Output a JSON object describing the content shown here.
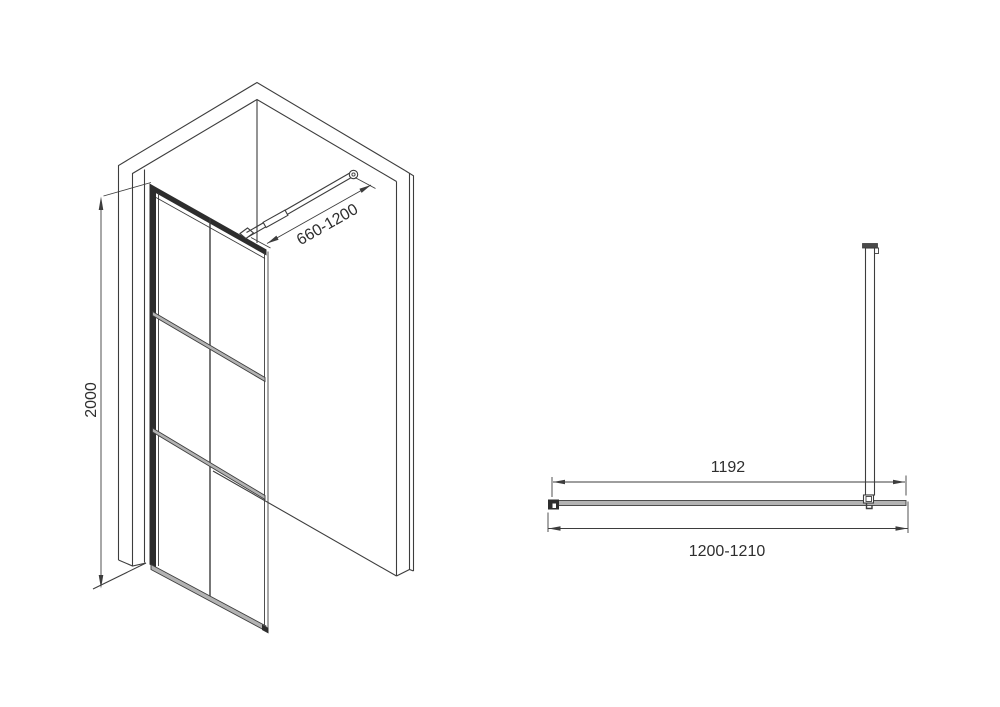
{
  "diagram": {
    "colors": {
      "line-color": "#3d3d3d",
      "text-color": "#2e2e2e",
      "glass-fill": "#b3b3b3",
      "frame-fill": "#2d2d2d",
      "cap-fill": "#4a4a4a",
      "background": "#ffffff"
    },
    "perspective_view": {
      "height_dimension": {
        "label": "2000"
      },
      "support_bar_dimension": {
        "label": "660-1200"
      }
    },
    "plan_view": {
      "glass_width_dimension": {
        "label": "1192"
      },
      "overall_width_dimension": {
        "label": "1200-1210"
      }
    }
  }
}
